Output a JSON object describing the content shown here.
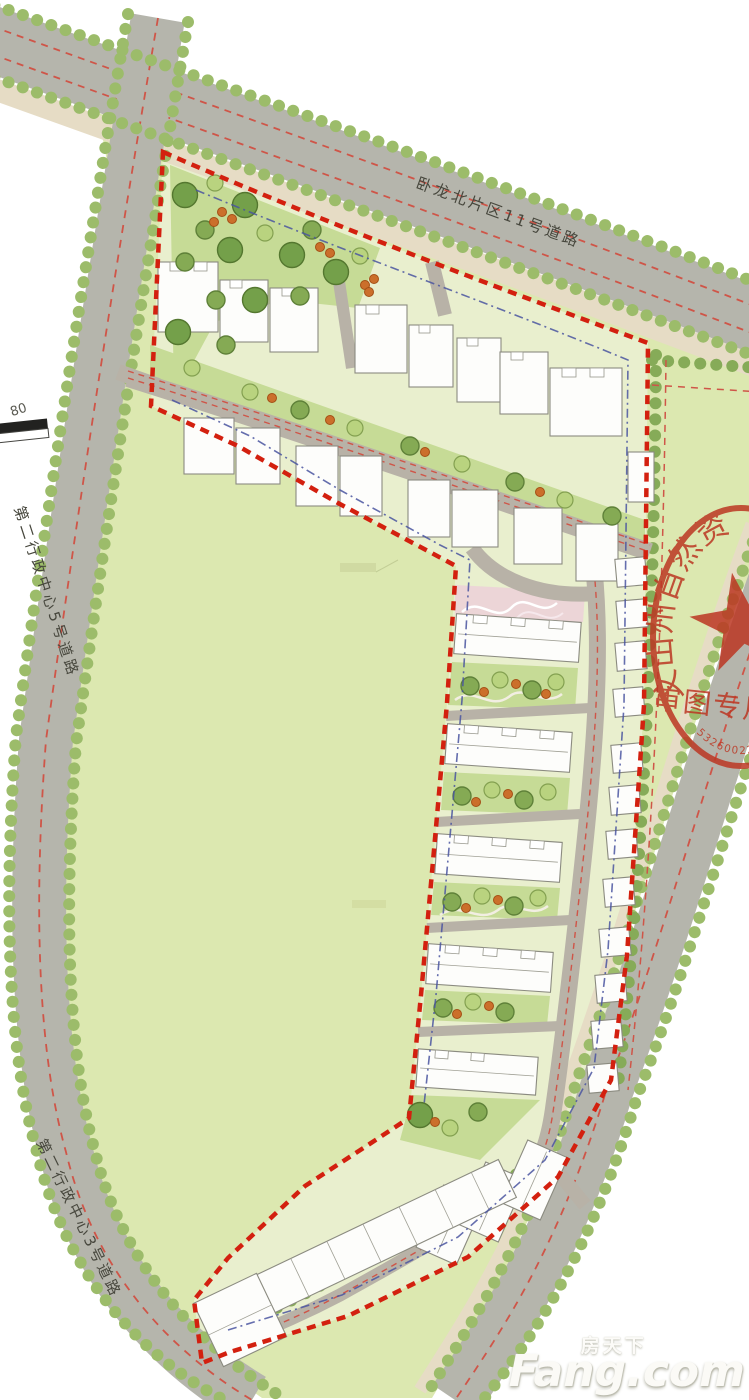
{
  "roads": {
    "top_label": "卧龙北片区11号道路",
    "left_label": "第二行政中心5号道路",
    "bottom_label": "第二行政中心3号道路"
  },
  "scale_bar": {
    "label": "80"
  },
  "seal": {
    "arc_text": "文山州自然资源",
    "stamp_title": "审图专用",
    "serial": "53260022049"
  },
  "watermark": {
    "cn": "房天下",
    "en": "Fang.com"
  },
  "colors": {
    "boundary_red": "#d3200f",
    "marking_red": "#cf5548",
    "setback_blue": "#4a55a0",
    "road_gray": "#b5b5ac",
    "inner_road_gray": "#b8b2a7",
    "sidewalk_tan": "#e6dcc5",
    "field_green": "#dce8b0",
    "site_green": "#e9efce",
    "courtyard_green": "#c6db96",
    "tree_green": "#7da34f",
    "tree_light": "#aec979",
    "scallop_green": "#9cbc6a",
    "shrub_orange": "#c96a28",
    "building_white": "#fdfdfb",
    "seal_red": "#bc3723",
    "entry_pink": "#ecd0d8"
  }
}
